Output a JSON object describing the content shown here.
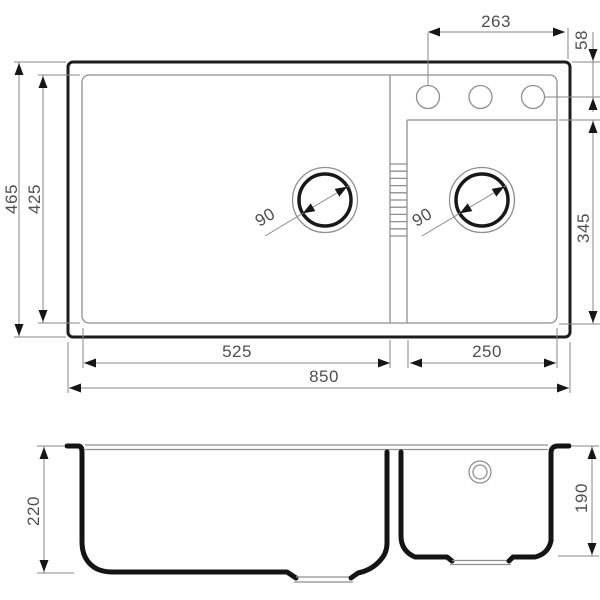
{
  "top_view": {
    "overall_length": "850",
    "overall_width": "465",
    "inner_width": "425",
    "left_bowl_length": "525",
    "right_bowl_length": "250",
    "right_bowl_width": "345",
    "faucet_holes_span": "263",
    "faucet_holes_offset": "58",
    "left_drain_diameter": "90",
    "right_drain_diameter": "90"
  },
  "section_view": {
    "left_bowl_depth": "220",
    "right_bowl_depth": "190"
  },
  "colors": {
    "outline_dark": "#1c1c1c",
    "thin_line": "#8f8f8f",
    "dimension_line": "#878787",
    "arrow": "#161616",
    "label_text": "#4f4f4f",
    "background": "#ffffff"
  }
}
